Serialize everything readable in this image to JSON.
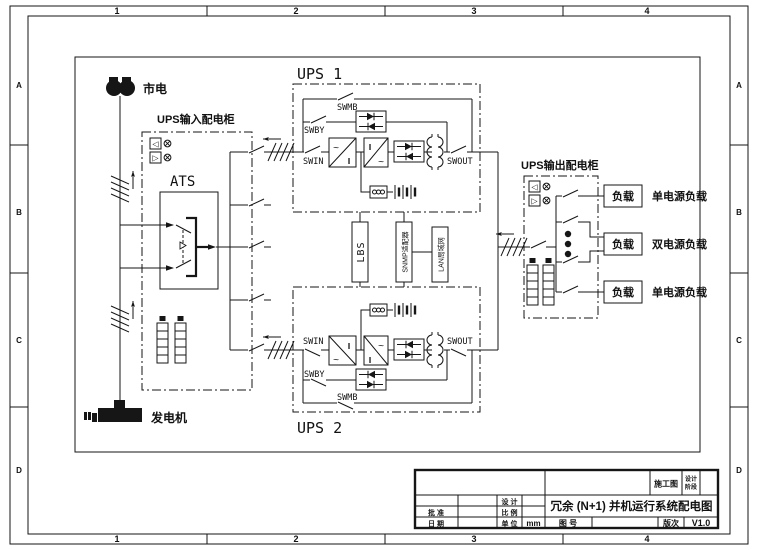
{
  "zones": {
    "cols": [
      "1",
      "2",
      "3",
      "4"
    ],
    "rows": [
      "A",
      "B",
      "C",
      "D"
    ]
  },
  "icons": {
    "meter_left": "◁",
    "meter_right": "▷"
  },
  "symbols": {
    "ac": "~",
    "dc": "‖"
  },
  "diagram": {
    "mains_label": "市电",
    "generator_label": "发电机",
    "input_cabinet_label": "UPS输入配电柜",
    "output_cabinet_label": "UPS输出配电柜",
    "ats_label": "ATS",
    "ups1_label": "UPS 1",
    "ups2_label": "UPS 2",
    "swin": "SWIN",
    "swout": "SWOUT",
    "swby": "SWBY",
    "swmb": "SWMB",
    "lbs": "LBS",
    "snmp": "SNMP适配器",
    "lan": "LAN局域网",
    "load": "负载",
    "load_types": [
      "单电源负载",
      "双电源负载",
      "单电源负载"
    ]
  },
  "title_block": {
    "stage_value": "施工图",
    "stage_label_top": "设计",
    "stage_label_bottom": "阶段",
    "design": "设 计",
    "approve": "批 准",
    "scale": "比 例",
    "date": "日 期",
    "unit": "单 位",
    "unit_value": "mm",
    "drawing_no": "图 号",
    "version": "版次",
    "version_value": "V1.0",
    "title": "冗余 (N+1) 并机运行系统配电图"
  }
}
